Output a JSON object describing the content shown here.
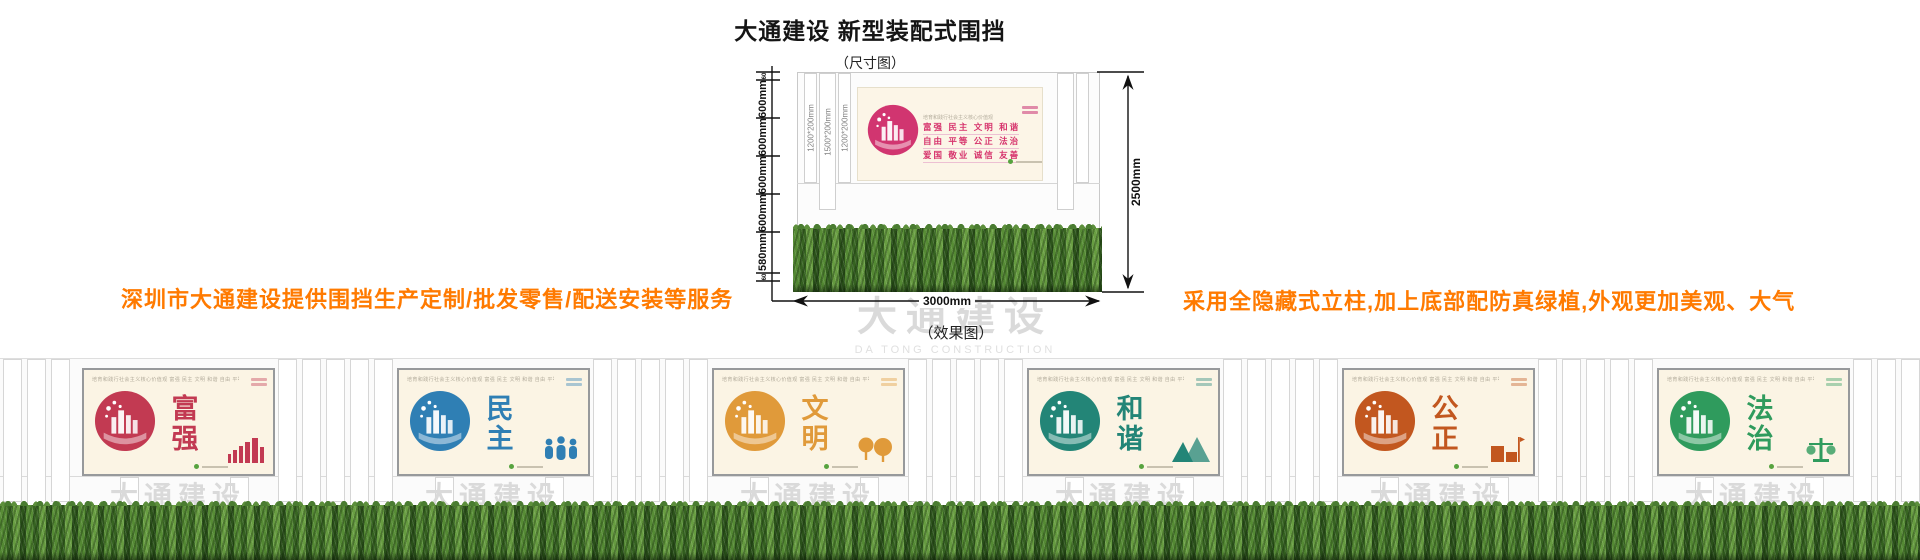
{
  "header": {
    "title": "大通建设 新型装配式围挡",
    "dimension_caption": "（尺寸图）",
    "effect_caption": "（效果图）"
  },
  "notes": {
    "left": "深圳市大通建设提供围挡生产定制/批发零售/配送安装等服务",
    "right": "采用全隐藏式立柱,加上底部配防真绿植,外观更加美观、大气",
    "accent_color": "#ff7a00"
  },
  "watermark": {
    "cn": "大通建设",
    "en": "DA TONG CONSTRUCTION"
  },
  "diagram": {
    "total_height_label": "2500mm",
    "total_width_label": "3000mm",
    "left_segments": [
      "60",
      "600mm",
      "600mm",
      "600mm",
      "600mm",
      "580mm",
      "60"
    ],
    "slat_labels": [
      "1200*200mm",
      "1500*200mm",
      "1200*200mm"
    ],
    "poster": {
      "header_micro": "培育和践行社会主义核心价值观",
      "values_rows": [
        "富强 民主 文明 和谐",
        "自由 平等 公正 法治",
        "爱国 敬业 诚信 友善"
      ],
      "accent_color": "#d6336c"
    }
  },
  "effect": {
    "values_strip_full": "培育和践行社会主义核心价值观  富强 民主 文明 和谐 自由 平等 公正 法治 爱国 敬业 诚信 友善",
    "panels": [
      {
        "title": "富强",
        "color": "#c23a52",
        "icon": "city-bars-icon"
      },
      {
        "title": "民主",
        "color": "#2f7fb4",
        "icon": "people-icon"
      },
      {
        "title": "文明",
        "color": "#e09a3a",
        "icon": "trees-icon"
      },
      {
        "title": "和谐",
        "color": "#238577",
        "icon": "mountains-icon"
      },
      {
        "title": "公正",
        "color": "#c2571f",
        "icon": "building-flag-icon"
      },
      {
        "title": "法治",
        "color": "#2f9b5d",
        "icon": "justice-figure-icon"
      }
    ]
  }
}
